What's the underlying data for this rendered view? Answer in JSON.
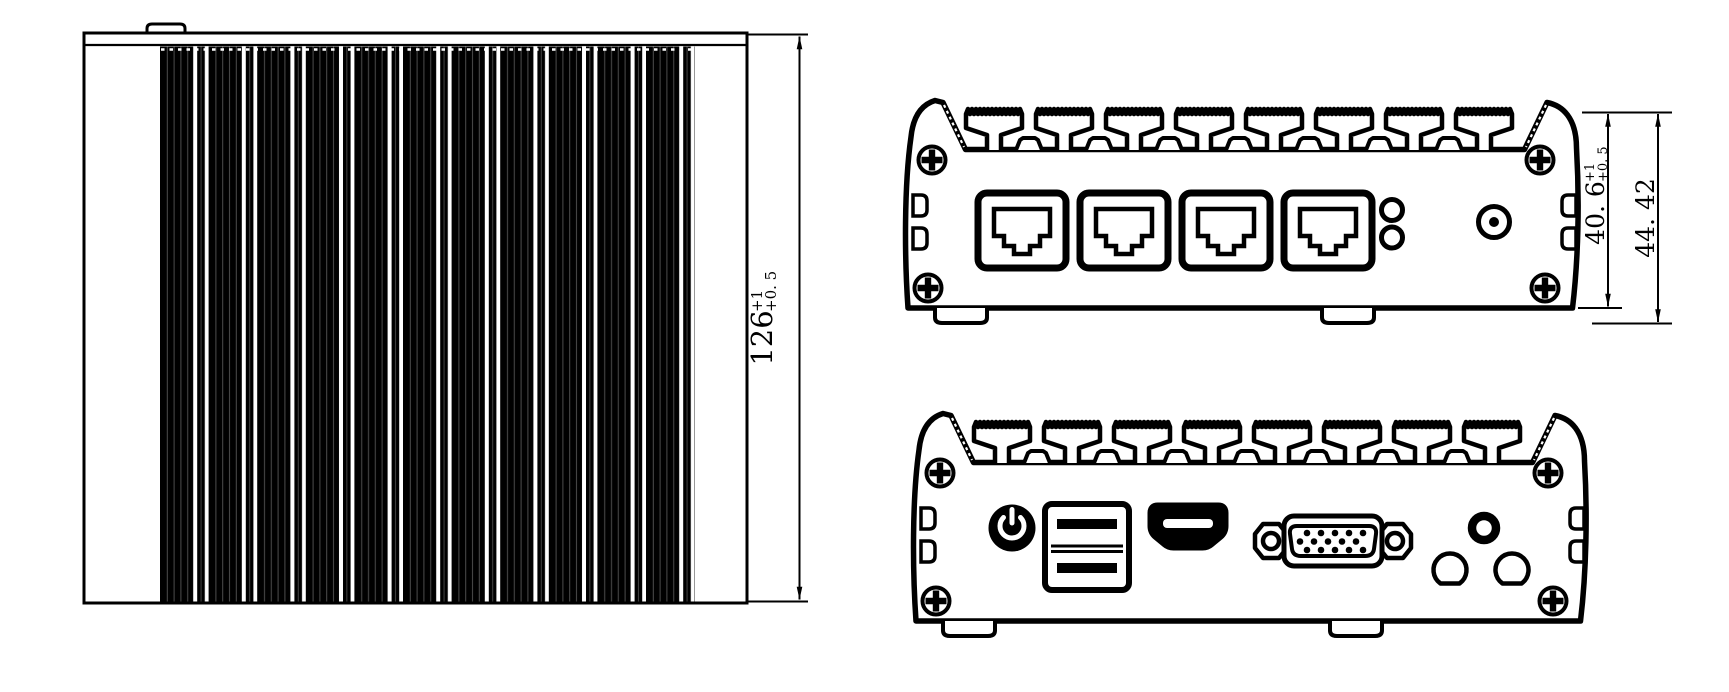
{
  "colors": {
    "line": "#000000",
    "background": "#ffffff"
  },
  "dimensions": {
    "overall_depth": {
      "value": "126",
      "tol_upper": "+1",
      "tol_lower": "+0. 5"
    },
    "body_height": {
      "value": "40. 6",
      "tol_upper": "+1",
      "tol_lower": "+0. 5"
    },
    "overall_height": {
      "value": "44. 42"
    }
  }
}
